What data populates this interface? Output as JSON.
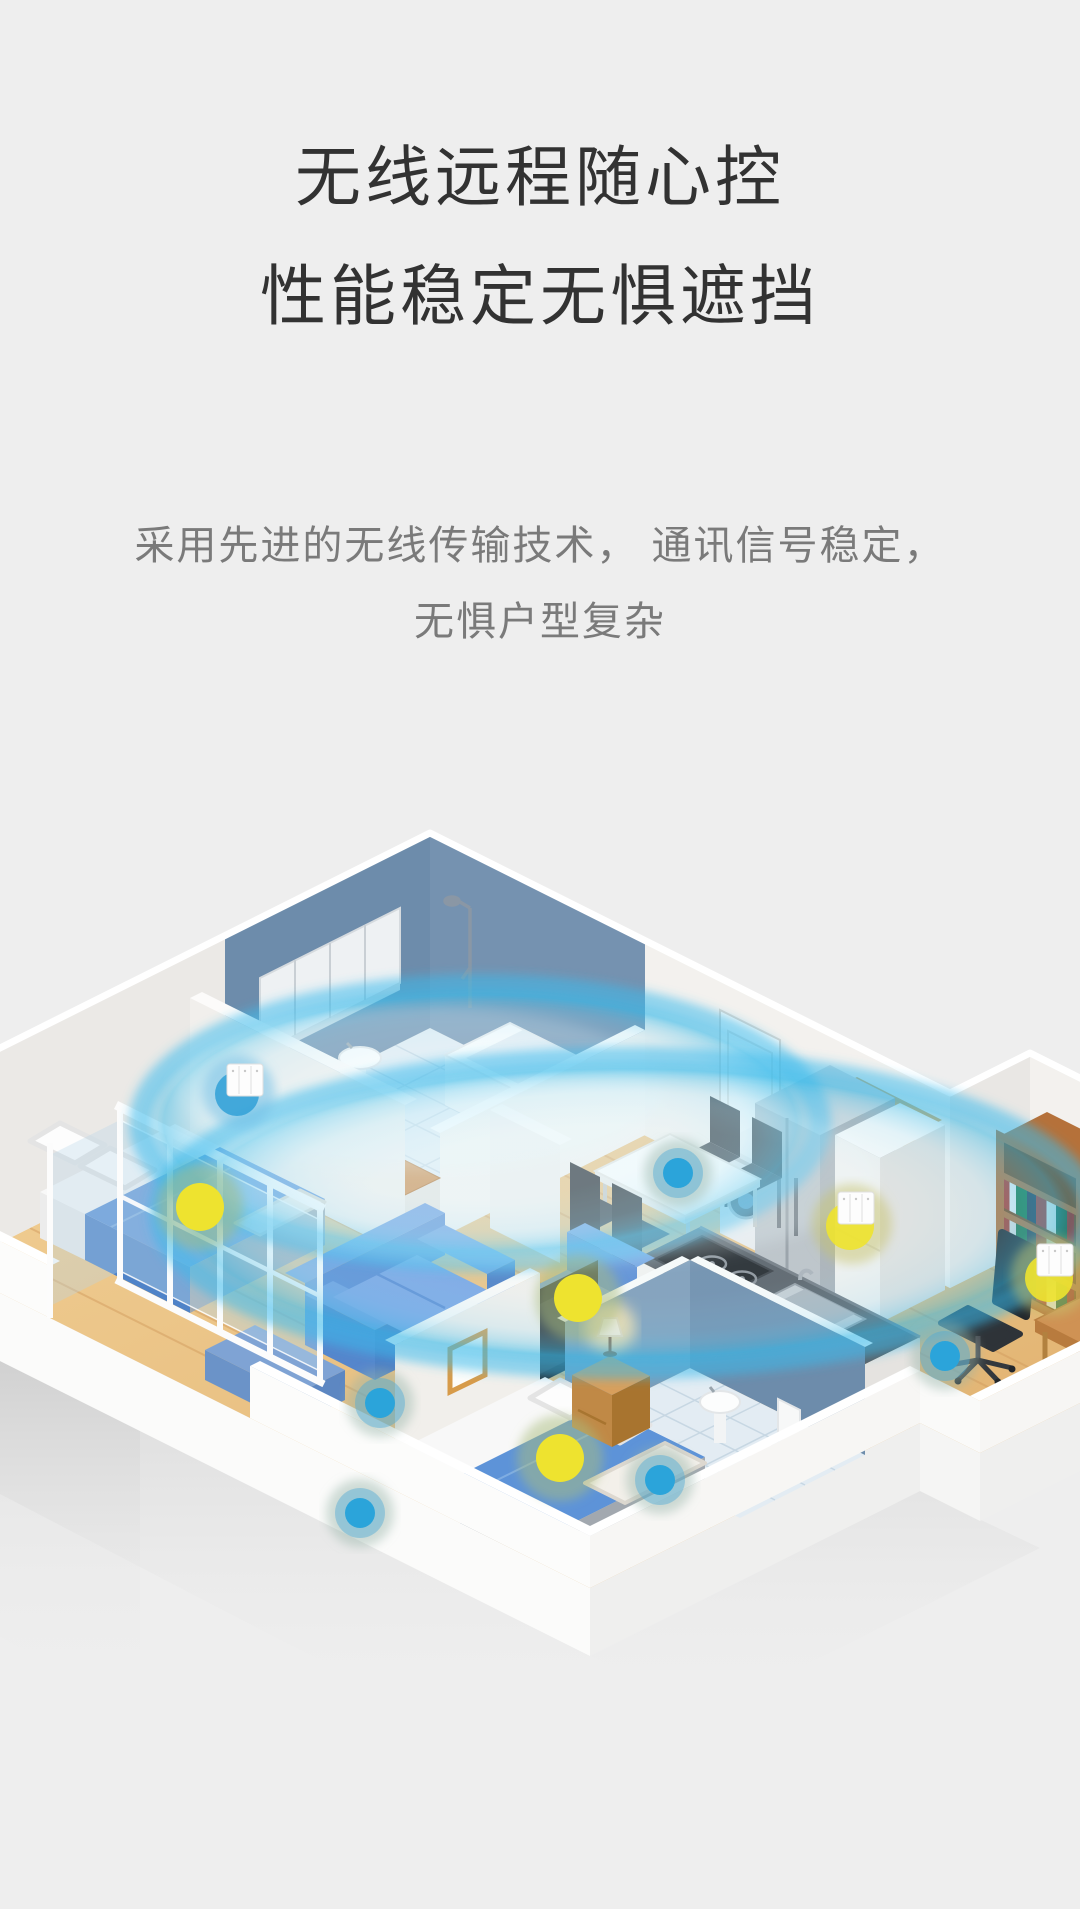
{
  "page": {
    "background": "#eeeeee"
  },
  "hero": {
    "title_line1": "无线远程随心控",
    "title_line2": "性能稳定无惧遮挡",
    "subtitle_line1": "采用先进的无线传输技术， 通讯信号稳定，",
    "subtitle_line2": "无惧户型复杂"
  },
  "illustration": {
    "description": "isometric smart-home floorplan with wireless coverage rings and glowing device nodes",
    "accent_colors": {
      "signal_ring": "#38bae8",
      "device_yellow": "#eee32f",
      "device_blue": "#2ba4da",
      "wall_blue": "#7592b0",
      "wood_floor": "#eac487",
      "sofa_blue": "#5b8dd4"
    },
    "signal_rings": [
      {
        "cx": 480,
        "cy": 455,
        "rx": 340,
        "ry": 138
      },
      {
        "cx": 625,
        "cy": 545,
        "rx": 465,
        "ry": 155
      }
    ],
    "nodes": [
      {
        "type": "switch",
        "halo": "blue",
        "x": 245,
        "y": 412
      },
      {
        "type": "switch",
        "halo": "yellow",
        "x": 856,
        "y": 540
      },
      {
        "type": "switch",
        "halo": "yellow",
        "x": 1055,
        "y": 592
      },
      {
        "type": "dot-yellow",
        "x": 200,
        "y": 539
      },
      {
        "type": "dot-yellow",
        "x": 578,
        "y": 630
      },
      {
        "type": "dot-yellow",
        "x": 560,
        "y": 790
      },
      {
        "type": "dot-blue",
        "x": 678,
        "y": 505
      },
      {
        "type": "dot-blue",
        "x": 380,
        "y": 735
      },
      {
        "type": "dot-blue",
        "x": 360,
        "y": 845
      },
      {
        "type": "dot-blue",
        "x": 945,
        "y": 688
      },
      {
        "type": "dot-blue",
        "x": 660,
        "y": 812
      }
    ]
  }
}
